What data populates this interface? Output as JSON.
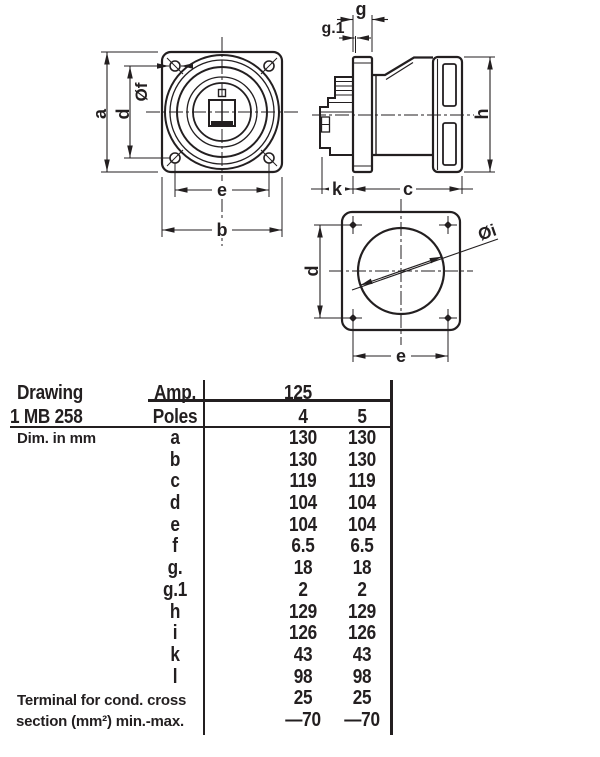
{
  "colors": {
    "ink": "#231f20",
    "background": "#ffffff"
  },
  "views": {
    "front": {
      "dim_a": "a",
      "dim_d": "d",
      "dim_f": "Øf",
      "dim_e": "e",
      "dim_b": "b"
    },
    "side": {
      "dim_g": "g",
      "dim_g1": "g.1",
      "dim_h": "h",
      "dim_k": "k",
      "dim_c": "c"
    },
    "rear": {
      "dim_d": "d",
      "dim_e": "e",
      "dim_i": "Øi"
    }
  },
  "table": {
    "drawing_label": "Drawing",
    "drawing_number": "1 MB 258",
    "amp_label": "Amp.",
    "amp_value": "125",
    "poles_label": "Poles",
    "poles_values": [
      "4",
      "5"
    ],
    "dim_note": "Dim. in mm",
    "rows": [
      {
        "key": "a",
        "v1": "130",
        "v2": "130"
      },
      {
        "key": "b",
        "v1": "130",
        "v2": "130"
      },
      {
        "key": "c",
        "v1": "119",
        "v2": "119"
      },
      {
        "key": "d",
        "v1": "104",
        "v2": "104"
      },
      {
        "key": "e",
        "v1": "104",
        "v2": "104"
      },
      {
        "key": "f",
        "v1": "6.5",
        "v2": "6.5"
      },
      {
        "key": "g.",
        "v1": "18",
        "v2": "18"
      },
      {
        "key": "g.1",
        "v1": "2",
        "v2": "2"
      },
      {
        "key": "h",
        "v1": "129",
        "v2": "129"
      },
      {
        "key": "i",
        "v1": "126",
        "v2": "126"
      },
      {
        "key": "k",
        "v1": "43",
        "v2": "43"
      },
      {
        "key": "l",
        "v1": "98",
        "v2": "98"
      }
    ],
    "terminal": {
      "label_line1": "Terminal for cond. cross",
      "label_line2": "section (mm²) min.-max.",
      "min_v1": "25",
      "min_v2": "25",
      "max_v1": "—70",
      "max_v2": "—70"
    }
  }
}
